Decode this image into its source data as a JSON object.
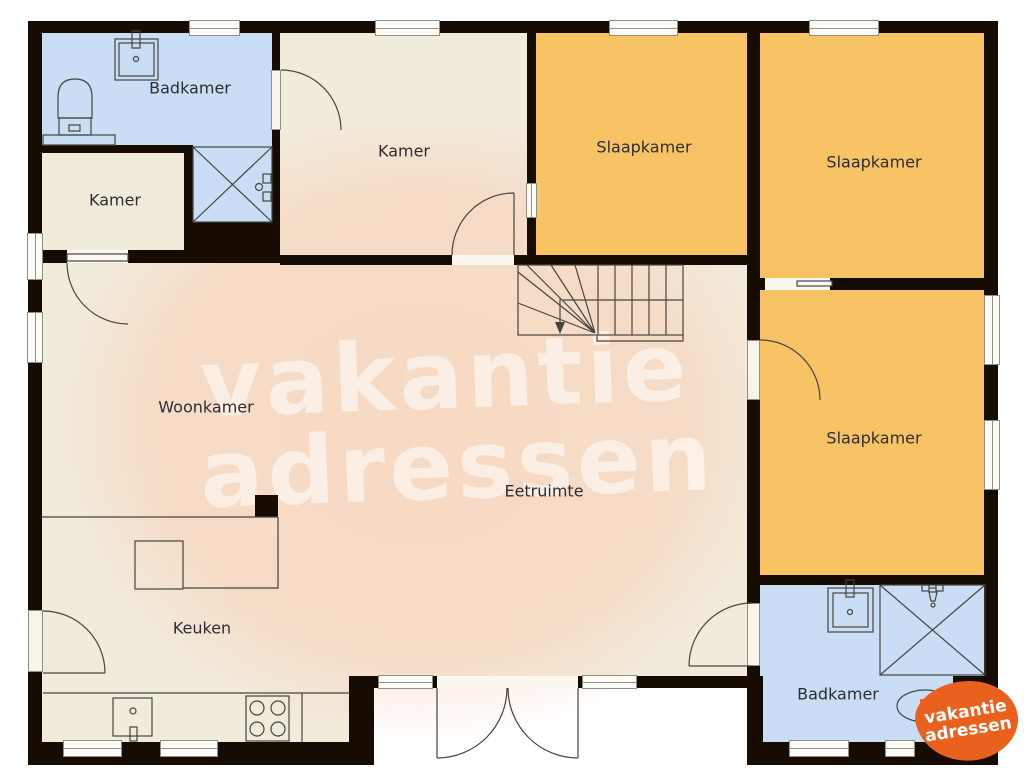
{
  "floorplan": {
    "title": "House floor plan",
    "rooms": [
      {
        "id": "badkamer-1",
        "label": "Badkamer"
      },
      {
        "id": "kamer-left",
        "label": "Kamer"
      },
      {
        "id": "kamer-top",
        "label": "Kamer"
      },
      {
        "id": "slaapkamer-1",
        "label": "Slaapkamer"
      },
      {
        "id": "slaapkamer-2",
        "label": "Slaapkamer"
      },
      {
        "id": "slaapkamer-3",
        "label": "Slaapkamer"
      },
      {
        "id": "woonkamer",
        "label": "Woonkamer"
      },
      {
        "id": "eetruimte",
        "label": "Eetruimte"
      },
      {
        "id": "keuken",
        "label": "Keuken"
      },
      {
        "id": "badkamer-2",
        "label": "Badkamer"
      }
    ],
    "fixtures": [
      "toilet-icon",
      "sink-icon",
      "shower-icon",
      "shower-head-icon",
      "stairs-icon",
      "stair-direction-arrow-icon",
      "stove-icon",
      "kitchen-sink-icon",
      "kitchen-island-icon",
      "kitchen-counter-icon",
      "french-doors-icon",
      "door-swing-icon",
      "sliding-door-icon",
      "window-icon"
    ]
  },
  "watermark": {
    "line1": "vakantie",
    "line2": "adressen"
  },
  "logo": {
    "line1": "vakantie",
    "line2": "adressen"
  },
  "colors": {
    "wall": "#170c04",
    "beige": "#f1ebdc",
    "orange": "#f7c364",
    "blue": "#c9ddf4",
    "line": "#45453f",
    "label": "#2d2d33",
    "winfill": "#fcfbf5",
    "winborder": "#8f8f86",
    "logo": "#e9611d"
  }
}
